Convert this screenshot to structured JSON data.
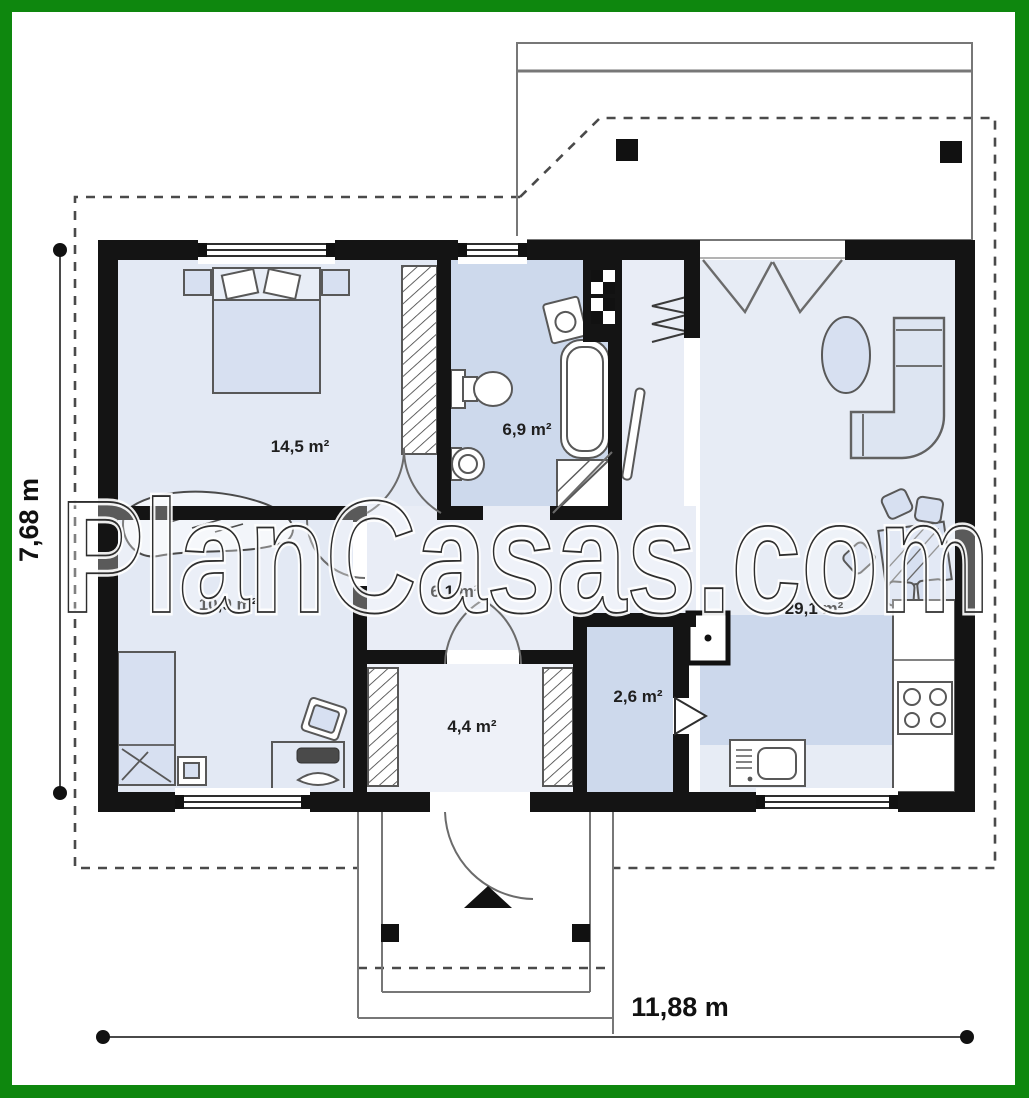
{
  "frame": {
    "border_color": "#0e870e"
  },
  "watermark": {
    "text": "PlanCasas.com"
  },
  "dimension_labels": {
    "height": "7,68 m",
    "width": "11,88 m"
  },
  "rooms": [
    {
      "name": "bedroom-1",
      "area": "14,5 m²"
    },
    {
      "name": "bathroom",
      "area": "6,9 m²"
    },
    {
      "name": "bedroom-2",
      "area": "10,9 m²"
    },
    {
      "name": "corridor",
      "area": "6,1 m²"
    },
    {
      "name": "living-room-kitchen",
      "area": "29,1 m²"
    },
    {
      "name": "storage",
      "area": "2,6 m²"
    },
    {
      "name": "entry-hall",
      "area": "4,4 m²"
    }
  ]
}
